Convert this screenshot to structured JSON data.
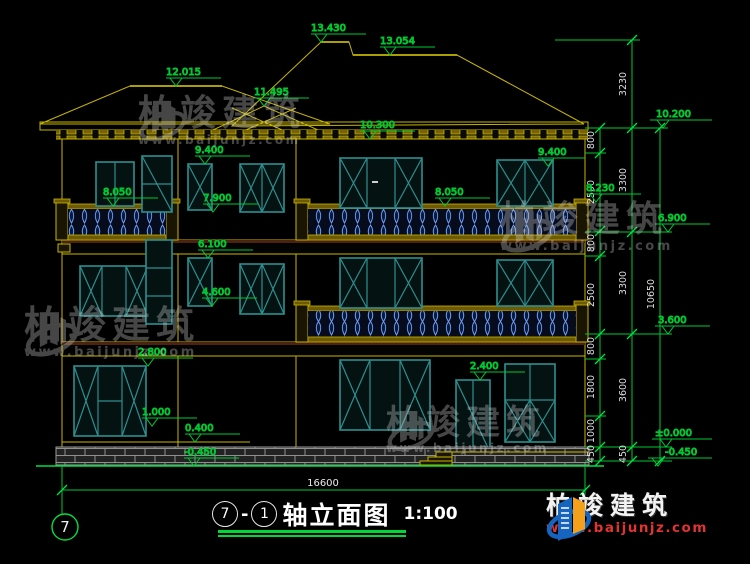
{
  "drawing": {
    "axis_bubble": "7",
    "title": {
      "axis_a": "7",
      "sep": "-",
      "axis_b": "1",
      "name": "轴立面图",
      "scale": "1:100"
    },
    "overall_width": "16600"
  },
  "elevations": {
    "ridge_main": "13.430",
    "ridge_right": "13.054",
    "ridge_left": "12.015",
    "gable_mid": "11.495",
    "porch_eave": "10.300",
    "eave_right": "10.200",
    "f3_head_left": "9.400",
    "f3_head_right": "9.400",
    "balcony3_rail_left": "8.050",
    "balcony3_rail_mid": "8.050",
    "balcony3_post_right": "8.230",
    "f3_sill_left": "7.900",
    "floor3": "6.900",
    "f2_head": "6.100",
    "f2_sill": "4.600",
    "floor2": "3.600",
    "f1_head": "2.800",
    "door_head": "2.400",
    "f1_sill": "1.000",
    "plinth_ledge": "0.400",
    "zero": "±0.000",
    "minus_left": "-0.450",
    "minus_right": "-0.450"
  },
  "dims": {
    "inner": [
      "800",
      "2500",
      "800",
      "2500",
      "800",
      "1800",
      "1000",
      "450"
    ],
    "middle": [
      "3230",
      "3300",
      "3300",
      "3600",
      "450"
    ],
    "outer": [
      "10650"
    ]
  },
  "watermark": {
    "brand": "柏竣建筑",
    "url": "www.baijunjz.com"
  },
  "logo": {
    "brand": "柏竣建筑",
    "url": "www.baijunjz.com"
  },
  "colors": {
    "cad_yellow": "#c8b400",
    "cad_green": "#00c832",
    "window_teal": "#2d8f8f",
    "baluster_blue": "#6f9fff",
    "logo_blue": "#1565c0",
    "logo_orange": "#f5a01a",
    "url_red": "#e23333"
  }
}
